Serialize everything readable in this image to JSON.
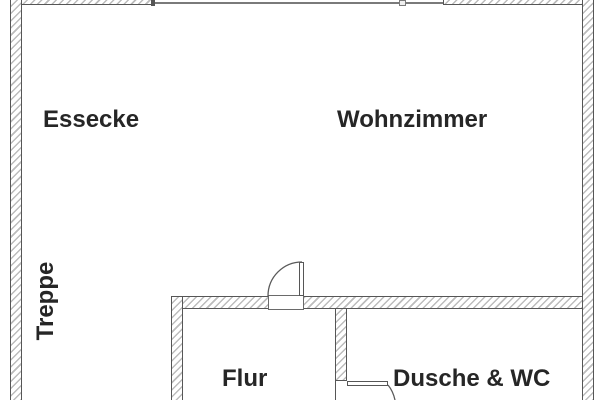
{
  "document": {
    "type": "floor-plan"
  },
  "rooms": {
    "essecke": {
      "label": "Essecke"
    },
    "wohnzimmer": {
      "label": "Wohnzimmer"
    },
    "treppe": {
      "label": "Treppe"
    },
    "flur": {
      "label": "Flur"
    },
    "dusche_wc": {
      "label": "Dusche & WC"
    }
  },
  "colors": {
    "background": "#ffffff",
    "wall_line": "#565656",
    "hatch": "#bcbcbc",
    "text": "#262626",
    "window_line": "#7a7a7a"
  }
}
